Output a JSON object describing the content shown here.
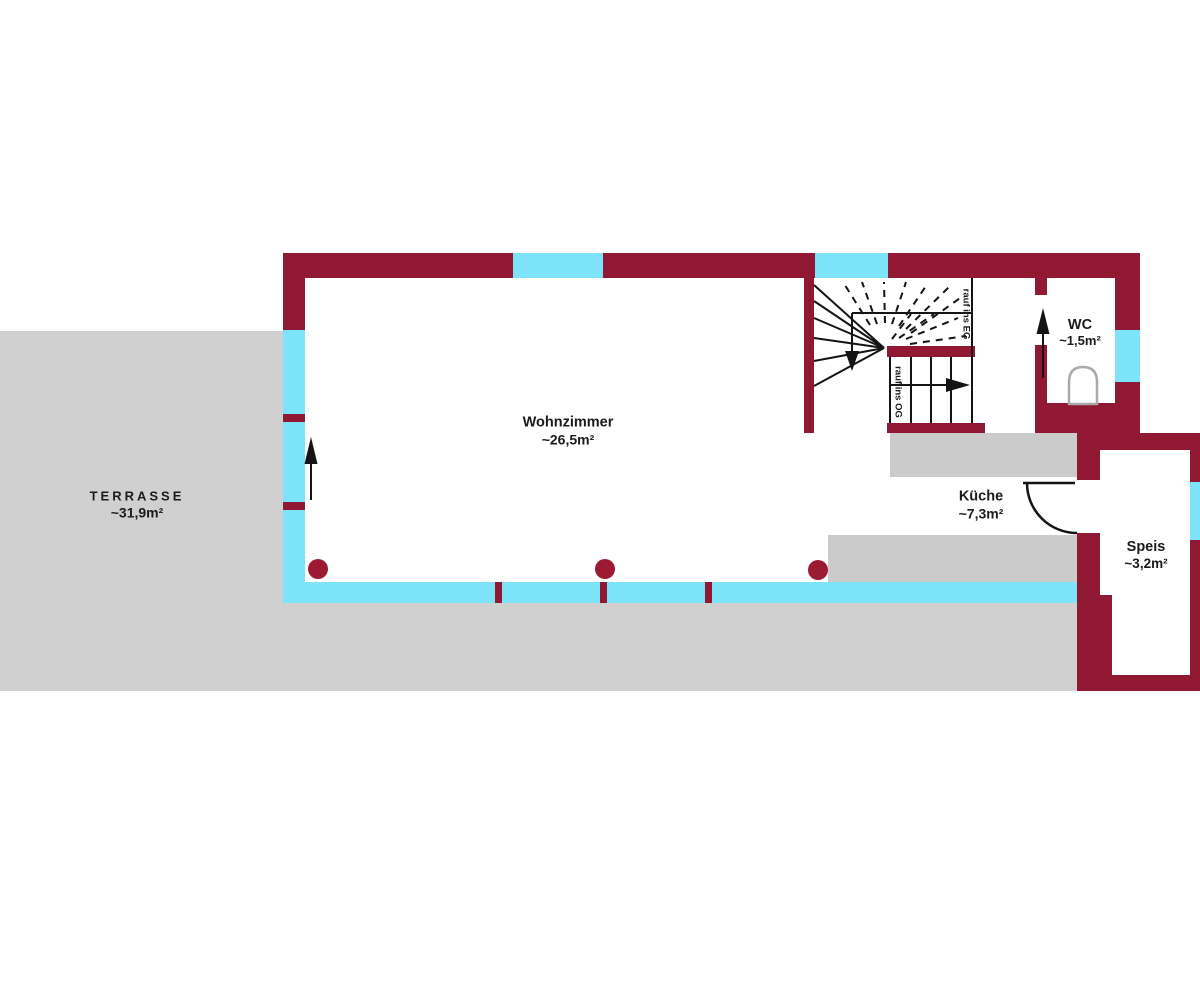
{
  "colors": {
    "wall": "#901833",
    "window": "#7DE3F8",
    "terrace": "#D0D0D0",
    "counter": "#CBCBCB",
    "column": "#9C1B33",
    "line": "#141414",
    "text": "#1B1B1B",
    "toilet_outline": "#A9A9A9"
  },
  "rooms": {
    "terrasse": {
      "name": "TERRASSE",
      "area": "~31,9m²"
    },
    "wohnzimmer": {
      "name": "Wohnzimmer",
      "area": "~26,5m²"
    },
    "kueche": {
      "name": "Küche",
      "area": "~7,3m²"
    },
    "wc": {
      "name": "WC",
      "area": "~1,5m²"
    },
    "speis": {
      "name": "Speis",
      "area": "~3,2m²"
    }
  },
  "stairs": {
    "down_to_ground_floor": "rauf ins EG",
    "up_to_first_floor": "rauf ins OG"
  }
}
